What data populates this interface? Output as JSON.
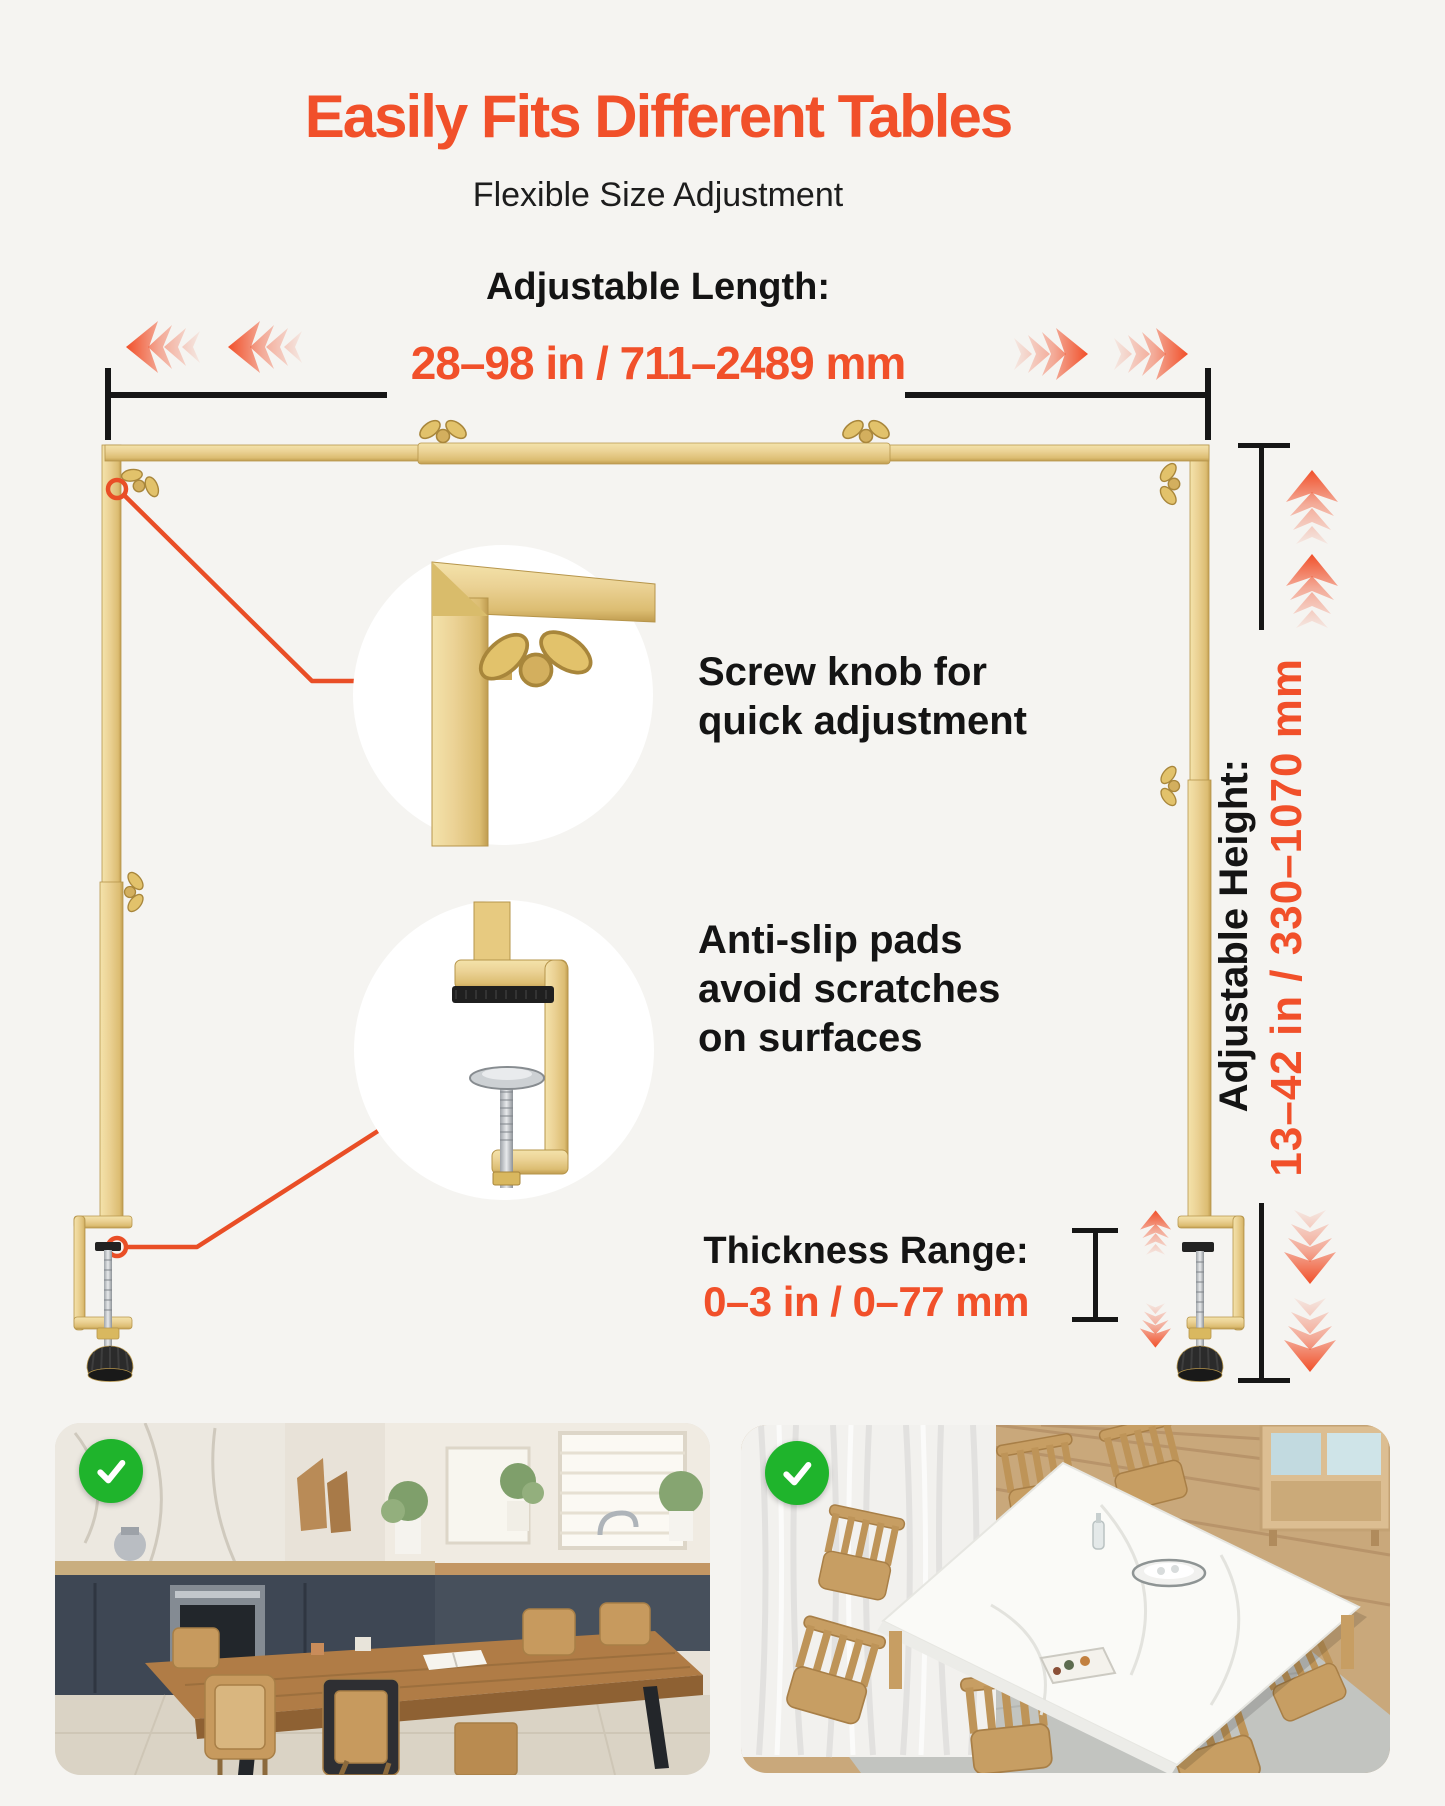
{
  "header": {
    "title": "Easily Fits Different Tables",
    "subtitle": "Flexible Size Adjustment"
  },
  "length": {
    "label": "Adjustable Length:",
    "value": "28–98 in / 711–2489 mm"
  },
  "height": {
    "label": "Adjustable Height:",
    "value": "13–42 in / 330–1070 mm"
  },
  "thickness": {
    "label": "Thickness Range:",
    "value": "0–3 in / 0–77 mm"
  },
  "callouts": {
    "screw_knob": {
      "line1": "Screw knob for",
      "line2": "quick adjustment"
    },
    "anti_slip": {
      "line1": "Anti-slip pads",
      "line2": "avoid scratches",
      "line3": "on surfaces"
    }
  },
  "photos": {
    "left": {
      "badge": "check",
      "description": "wooden dining table in kitchen"
    },
    "right": {
      "badge": "check",
      "description": "white marble dining table with wooden chairs"
    }
  },
  "icons": {
    "check_icon": "✓",
    "chevron_left_icon": "«",
    "chevron_right_icon": "»",
    "chevron_up_icon": "^",
    "chevron_down_icon": "v",
    "wing_nut_icon": "wing-nut",
    "ring_marker_icon": "ring-marker"
  },
  "colors": {
    "accent": "#F1502A",
    "gold": "#E9CF8C",
    "gold_dark": "#C09C4F",
    "text": "#161616",
    "background": "#F5F4F1",
    "check_green": "#1FB42C",
    "circle_bg": "#FFFFFF"
  }
}
